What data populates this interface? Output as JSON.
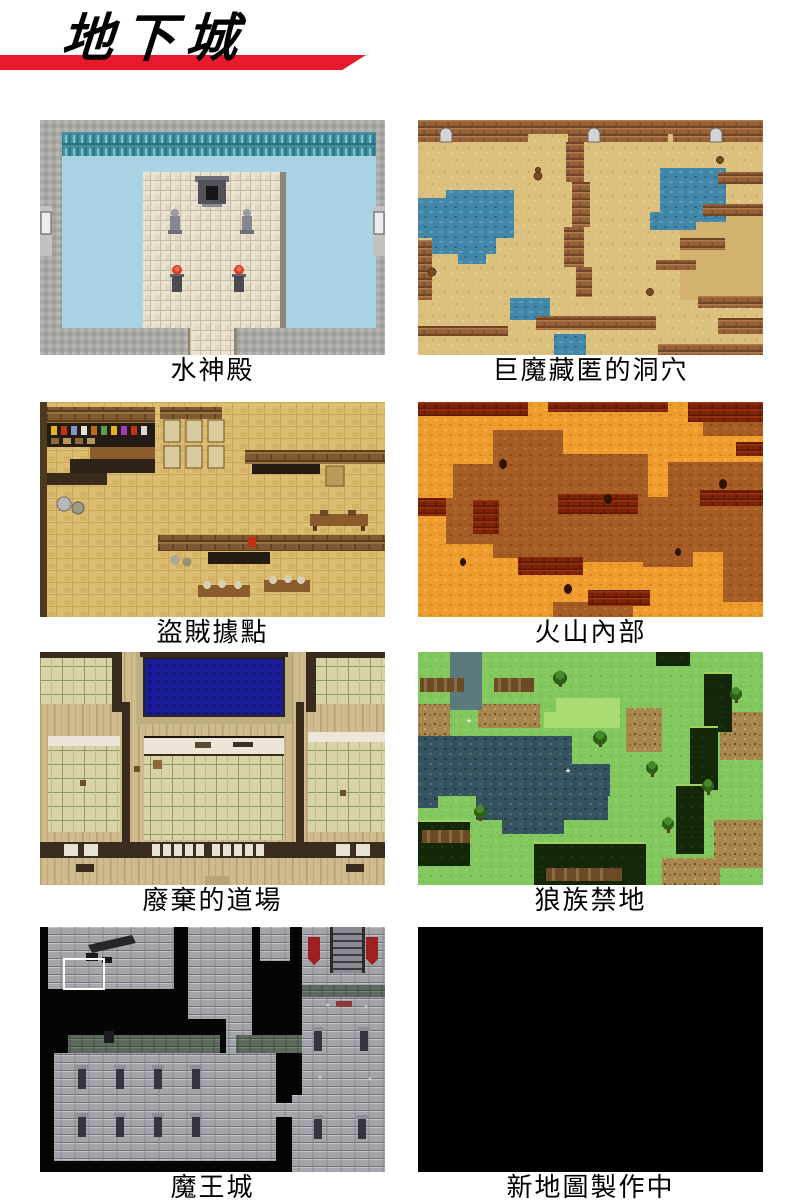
{
  "page": {
    "title": "地下城",
    "background": "#ffffff",
    "accent_red": "#e8192c",
    "text_color": "#000000"
  },
  "maps": [
    {
      "caption": "水神殿",
      "name": "water-temple",
      "palette": {
        "water": "#a9d2e4",
        "waterfall": "#43919f",
        "stone": "#a8a8a4",
        "platform": "#e9e3d0",
        "flame": "#e23b2d"
      }
    },
    {
      "caption": "巨魔藏匿的洞穴",
      "name": "troll-cave",
      "palette": {
        "sand": "#dcc07e",
        "ledge": "#96613a",
        "pool": "#4286a8",
        "door": "#d4d4d4"
      }
    },
    {
      "caption": "盜賊據點",
      "name": "thief-hideout",
      "palette": {
        "wood": "#dcbd72",
        "wall": "#7d5a31",
        "shelf": "#241c12",
        "cabinet": "#d9cb9e"
      }
    },
    {
      "caption": "火山內部",
      "name": "volcano-interior",
      "palette": {
        "lava_ground": "#ef9c2f",
        "plateau": "#a65c25",
        "cliff": "#7e2407"
      }
    },
    {
      "caption": "廢棄的道場",
      "name": "abandoned-dojo",
      "palette": {
        "plank": "#cfbb8e",
        "tatami": "#d8d2a6",
        "wall": "#3a2c1c",
        "pool": "#1a1d9a",
        "shoji": "#ece6d8"
      }
    },
    {
      "caption": "狼族禁地",
      "name": "wolf-forbidden-land",
      "palette": {
        "grass": "#83c75f",
        "dark_water": "#35535e",
        "dirt": "#a8874f",
        "chasm": "#142708"
      }
    },
    {
      "caption": "魔王城",
      "name": "demon-king-castle",
      "palette": {
        "void": "#050505",
        "stone": "#a4a4ab",
        "moss_wall": "#5e6a5e",
        "banner": "#9e2020"
      }
    },
    {
      "caption": "新地圖製作中",
      "name": "new-map-in-progress",
      "palette": {
        "fill": "#000000"
      }
    }
  ]
}
